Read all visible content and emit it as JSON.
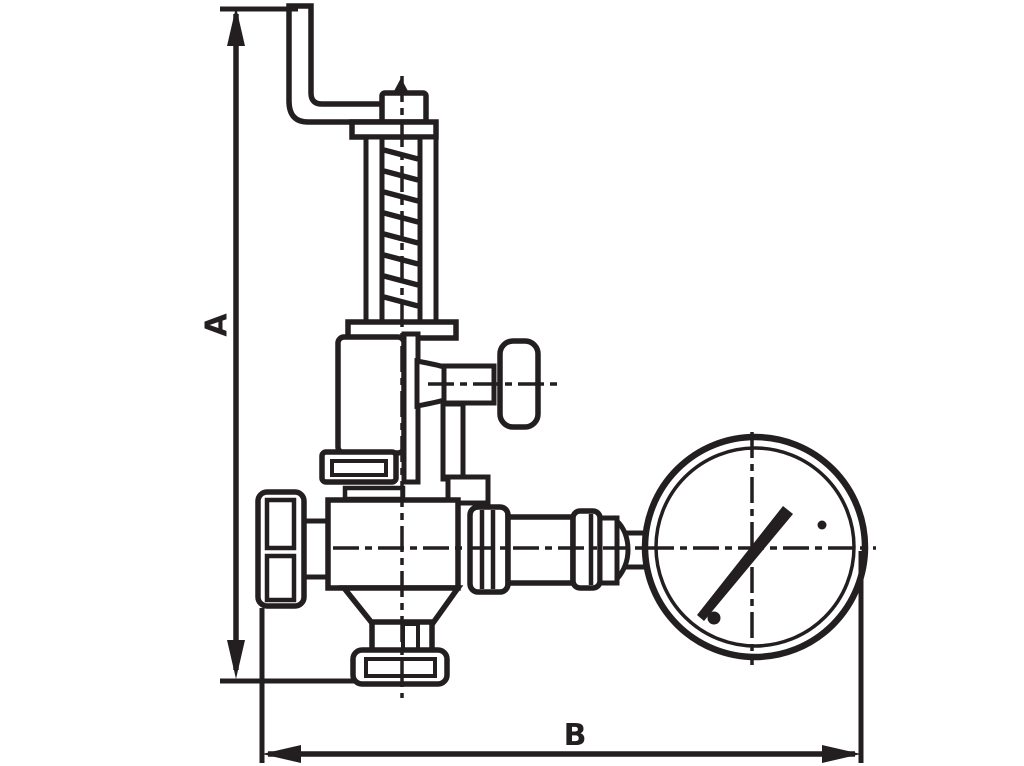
{
  "page": {
    "background_color": "#ffffff",
    "ink_color": "#231F20",
    "description": "Dimensioned outline line-drawing of a lever-operated safety relief valve with spring housing, side test connection and piped pressure gauge"
  },
  "dimensions": {
    "vertical": {
      "label": "A"
    },
    "horizontal": {
      "label": "B"
    }
  },
  "parts": [
    "lever-arm",
    "spindle-tip",
    "lever-fork",
    "spring-housing-cap",
    "spring-housing-rails",
    "spring-coils",
    "spring-housing-base",
    "bonnet",
    "spindle-column",
    "test-connection-pipe",
    "test-connection-cap",
    "bonnet-flange",
    "adjustment-cap",
    "valve-body",
    "body-taper",
    "inlet-neck",
    "inlet-flange",
    "union-nut",
    "gauge-pipe",
    "union-nut-2",
    "collar",
    "reducer",
    "gauge-stub",
    "pressure-gauge-dial",
    "gauge-needle",
    "gauge-pivot-dots",
    "centerlines"
  ]
}
